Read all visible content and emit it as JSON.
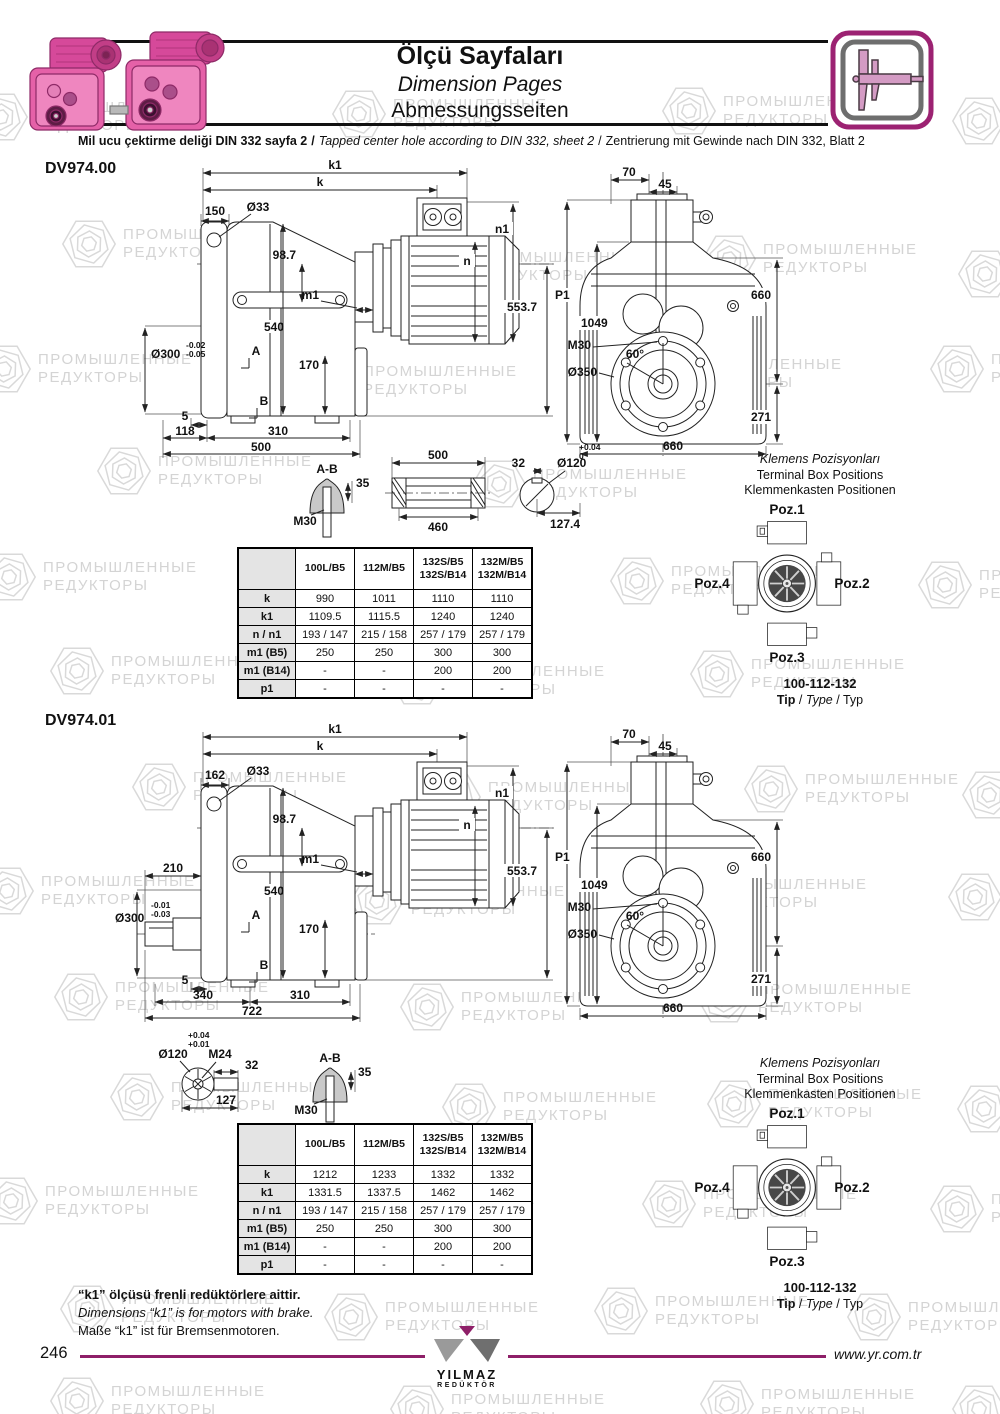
{
  "colors": {
    "accent": "#8e1f68",
    "pink": "#e561a8",
    "line": "#222222",
    "watermark": "#d4d4d4"
  },
  "watermark": {
    "line1": "ПРОМЫШЛЕННЫЕ",
    "line2": "РЕДУКТОРЫ"
  },
  "header": {
    "title_tr": "Ölçü Sayfaları",
    "title_en": "Dimension Pages",
    "title_de": "Abmessungsseiten",
    "sep": "/",
    "subtitle_tr": "Mil ucu çektirme deliği DIN 332 sayfa 2",
    "subtitle_en": "Tapped center hole according to DIN 332, sheet 2",
    "subtitle_de": "Zentrierung mit Gewinde nach DIN 332, Blatt 2",
    "caliper_icon": "caliper-icon",
    "product_image": "pink-gearmotors"
  },
  "terminal": {
    "cap_tr": "Klemens Pozisyonları",
    "cap_en": "Terminal Box Positions",
    "cap_de": "Klemmenkasten Positionen",
    "poz1": "Poz.1",
    "poz2": "Poz.2",
    "poz3": "Poz.3",
    "poz4": "Poz.4",
    "range": "100-112-132",
    "tip": "Tip",
    "type": "Type",
    "typ": "Typ"
  },
  "dv00": {
    "code": "DV974.00",
    "side": {
      "k1": "k1",
      "k": "k",
      "off": "150",
      "hole": "Ø33",
      "n1": "n1",
      "n": "n",
      "h1": "98.7",
      "m1": "m1",
      "len": "553.7",
      "mid": "540",
      "shaft": "Ø300",
      "tol1": "-0.02",
      "tol2": "-0.05",
      "a": "A",
      "f170": "170",
      "g5": "5",
      "b": "B",
      "b1": "118",
      "b2": "310",
      "b3": "500"
    },
    "front": {
      "t70": "70",
      "t45": "45",
      "p1": "P1",
      "h": "1049",
      "r660": "660",
      "deg": "60°",
      "m30": "M30",
      "fl": "Ø350",
      "r271": "271",
      "b660": "660"
    },
    "det": {
      "ab": "A-B",
      "k35": "35",
      "m30": "M30",
      "l500": "500",
      "l460": "460",
      "w32": "32",
      "bore": "Ø120",
      "tol1": "+0.04",
      "tol2": "0",
      "l1274": "127.4"
    },
    "table": {
      "cols": [
        [
          "100L/B5"
        ],
        [
          "112M/B5"
        ],
        [
          "132S/B5",
          "132S/B14"
        ],
        [
          "132M/B5",
          "132M/B14"
        ]
      ],
      "rows": [
        [
          "k",
          "990",
          "1011",
          "1110",
          "1110"
        ],
        [
          "k1",
          "1109.5",
          "1115.5",
          "1240",
          "1240"
        ],
        [
          "n / n1",
          "193 / 147",
          "215 / 158",
          "257 / 179",
          "257 / 179"
        ],
        [
          "m1 (B5)",
          "250",
          "250",
          "300",
          "300"
        ],
        [
          "m1 (B14)",
          "-",
          "-",
          "200",
          "200"
        ],
        [
          "p1",
          "-",
          "-",
          "-",
          "-"
        ]
      ]
    }
  },
  "dv01": {
    "code": "DV974.01",
    "side": {
      "k1": "k1",
      "k": "k",
      "off": "162",
      "hole": "Ø33",
      "n1": "n1",
      "n": "n",
      "h1": "98.7",
      "m1": "m1",
      "len": "553.7",
      "mid": "540",
      "d210": "210",
      "shaft": "Ø300",
      "tol1": "-0.01",
      "tol2": "-0.03",
      "a": "A",
      "f170": "170",
      "g5": "5",
      "b": "B",
      "b1": "340",
      "b2": "310",
      "b3": "722"
    },
    "front": {
      "t70": "70",
      "t45": "45",
      "p1": "P1",
      "h": "1049",
      "r660": "660",
      "deg": "60°",
      "m30": "M30",
      "fl": "Ø350",
      "r271": "271",
      "b660": "660"
    },
    "det": {
      "bore": "Ø120",
      "tol1": "+0.04",
      "tol2": "+0.01",
      "m24": "M24",
      "w32": "32",
      "l127": "127",
      "ab": "A-B",
      "k35": "35",
      "m30": "M30"
    },
    "table": {
      "cols": [
        [
          "100L/B5"
        ],
        [
          "112M/B5"
        ],
        [
          "132S/B5",
          "132S/B14"
        ],
        [
          "132M/B5",
          "132M/B14"
        ]
      ],
      "rows": [
        [
          "k",
          "1212",
          "1233",
          "1332",
          "1332"
        ],
        [
          "k1",
          "1331.5",
          "1337.5",
          "1462",
          "1462"
        ],
        [
          "n / n1",
          "193 / 147",
          "215 / 158",
          "257 / 179",
          "257 / 179"
        ],
        [
          "m1 (B5)",
          "250",
          "250",
          "300",
          "300"
        ],
        [
          "m1 (B14)",
          "-",
          "-",
          "200",
          "200"
        ],
        [
          "p1",
          "-",
          "-",
          "-",
          "-"
        ]
      ]
    }
  },
  "footer": {
    "note_tr": "“k1” ölçüsü frenli redüktörlere aittir.",
    "note_en": "Dimensions “k1” is for motors with brake.",
    "note_de": "Maße “k1” ist für Bremsenmotoren.",
    "page": "246",
    "url": "www.yr.com.tr",
    "logo1": "YILMAZ",
    "logo2": "REDÜKTÖR"
  }
}
